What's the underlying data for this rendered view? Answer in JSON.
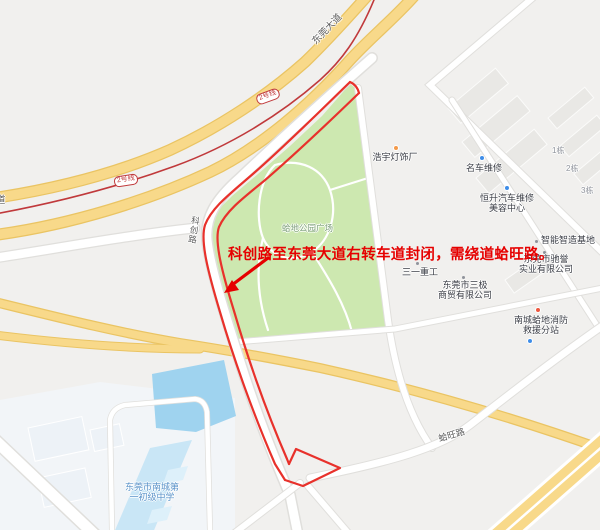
{
  "colors": {
    "background": "#f1f0ee",
    "road_yellow": "#f8d98a",
    "road_yellow_casing": "#eac463",
    "road_white": "#ffffff",
    "road_casing": "#e0dfdc",
    "park_green": "#cde8b0",
    "water_blue": "#9fd3ef",
    "school_blue": "#c9e6f6",
    "campus_light": "#f2f5f8",
    "building_gray": "#e9e8e5",
    "building_light": "#edf2f7",
    "metro_red": "#c0393b",
    "route_red": "#e8312b",
    "annotation_red": "#e60000",
    "poi_text": "#3b3e46",
    "road_label_text": "#5c5c5c",
    "blue_label": "#5b93c9",
    "park_label": "#7fa07c",
    "dot_blue": "#3e8de8",
    "dot_orange": "#f49a4a",
    "dot_red": "#ed573f",
    "building_label_gray": "#8f939b"
  },
  "map": {
    "annotation": {
      "text": "科创路至东莞大道右转车道封闭，需绕道蛤旺路。"
    },
    "road_labels": {
      "dongguan_avenue": "东莞大道",
      "kechuang_road": "科创路",
      "hawang_road": "蛤旺路",
      "left_edge_partial": "道",
      "metro_badge": "2号线"
    },
    "area_labels": {
      "park": "蛤地公园广场"
    },
    "pois": {
      "haoyu": {
        "name": "浩宇灯饰厂"
      },
      "mingche": {
        "name": "名车维修"
      },
      "hengsheng": {
        "line1": "恒升汽车维修",
        "line2": "美容中心"
      },
      "zhineng": {
        "name": "智能智造基地"
      },
      "chiyu": {
        "line1": "东莞市驰誉",
        "line2": "实业有限公司"
      },
      "sanyi": {
        "name": "三一重工"
      },
      "sanji": {
        "line1": "东莞市三极",
        "line2": "商贸有限公司"
      },
      "xiaofang": {
        "line1": "南城蛤地消防",
        "line2": "救援分站"
      },
      "school": {
        "line1": "东莞市南城第",
        "line2": "一初级中学"
      }
    },
    "building_labels": [
      "1栋",
      "2栋",
      "3栋"
    ]
  }
}
